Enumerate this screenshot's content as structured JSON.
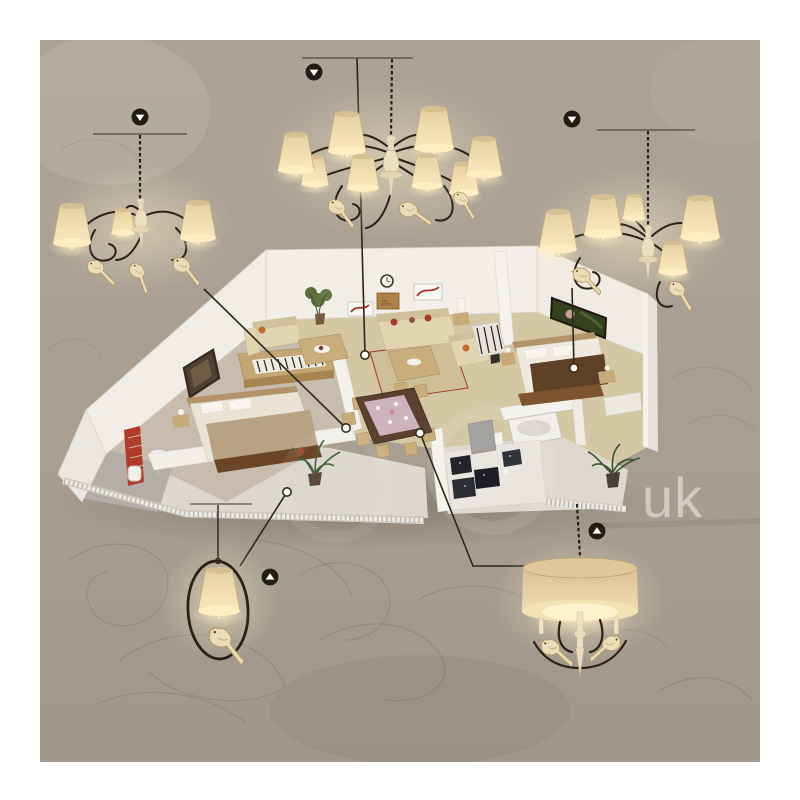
{
  "photo": {
    "background_color": "#a89f92",
    "border_color": "#ffffff",
    "watermark": {
      "text": "uk",
      "color": "#ffffff",
      "opacity": 0.47
    }
  },
  "palette": {
    "wire_color": "#2b2118",
    "shade_top": "#e6d0a2",
    "shade_bottom": "#fae8bd",
    "glow": "#ffeec2",
    "wall": "#f2efe9",
    "floor_living": "#d3c8a3",
    "floor_bedroom": "#c7bcae",
    "wood": "#c9ae7c",
    "dark_wood": "#5c4130",
    "accent_red": "#ae3d2b",
    "marker_background": "#241c10",
    "marker_glyph": "#ffffff",
    "dot_fill": "#fdfdfb",
    "dot_border": "#352b1c"
  },
  "scene": {
    "lamps": [
      {
        "id": "chandelier-3-arm-left",
        "visible_shades": 3,
        "marker_icon": "triangle-down"
      },
      {
        "id": "chandelier-8-arm-top",
        "visible_shades": 8,
        "marker_icon": "triangle-down"
      },
      {
        "id": "chandelier-6-arm-right",
        "visible_shades": 5,
        "marker_icon": "triangle-down"
      },
      {
        "id": "pendant-ring-bird",
        "visible_shades": 1,
        "marker_icon": "triangle-up"
      },
      {
        "id": "pendant-drum-bird",
        "visible_shades": 1,
        "marker_icon": "triangle-up"
      }
    ],
    "placement_dots": 5,
    "callout_lines": 5
  }
}
